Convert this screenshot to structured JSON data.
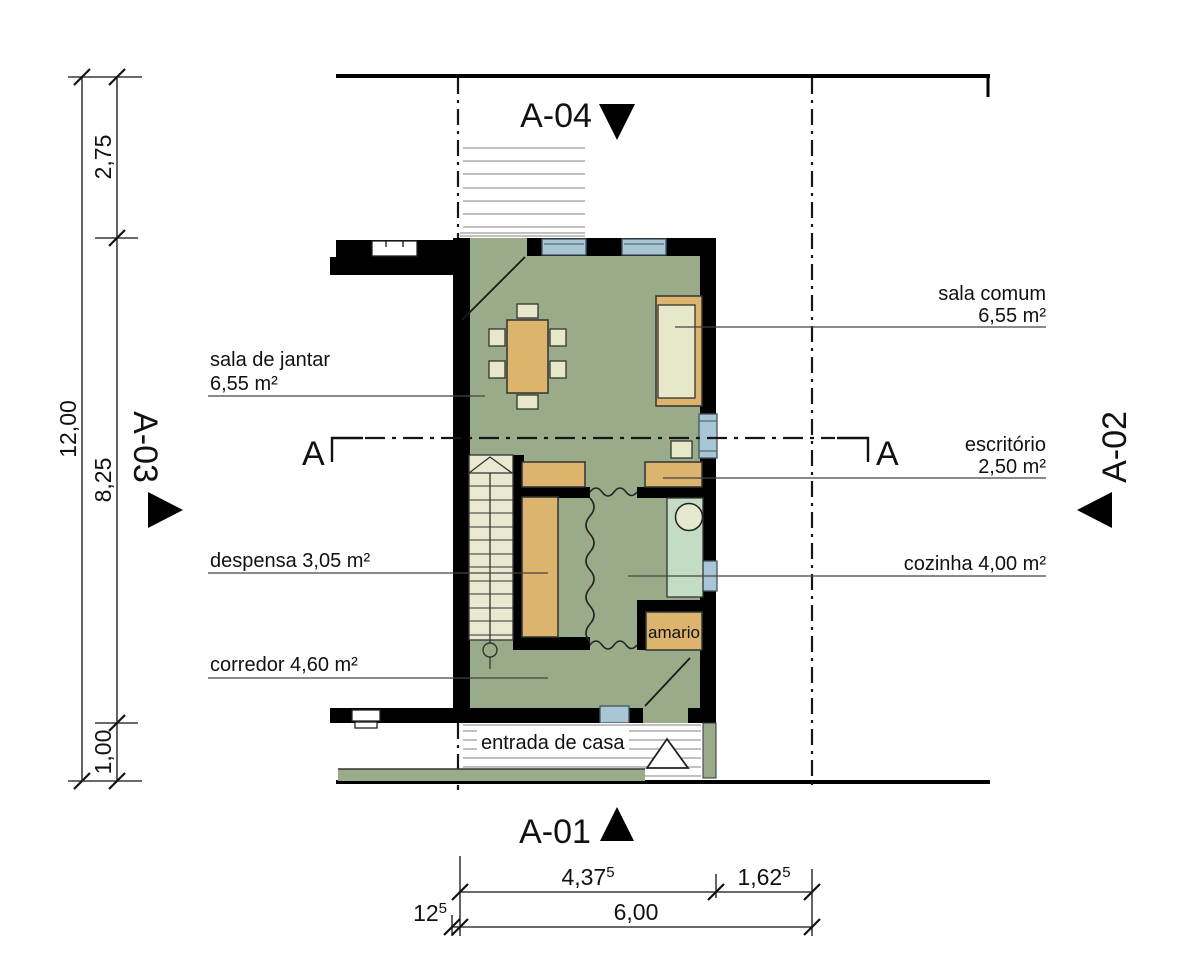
{
  "title": "floor-plan-ground-floor",
  "rooms": {
    "sala_de_jantar": {
      "name": "sala de jantar",
      "area": "6,55 m²"
    },
    "sala_comum": {
      "name": "sala comum",
      "area": "6,55 m²"
    },
    "escritorio": {
      "name": "escritório",
      "area": "2,50 m²"
    },
    "despensa": {
      "label": "despensa 3,05 m²"
    },
    "cozinha": {
      "label": "cozinha 4,00 m²"
    },
    "corredor": {
      "label": "corredor 4,60 m²"
    },
    "amario": {
      "label": "amario"
    },
    "entrada": {
      "label": "entrada de casa"
    }
  },
  "sections": {
    "top": "A-04",
    "bottom": "A-01",
    "left": "A-03",
    "right": "A-02",
    "cut_letter_left": "A",
    "cut_letter_right": "A"
  },
  "dimensions": {
    "left_total": "12,00",
    "left_seg_top": "2,75",
    "left_seg_mid": "8,25",
    "left_seg_bottom": "1,00",
    "bottom_seg1": {
      "v": "4,37",
      "sup": "5"
    },
    "bottom_seg2": {
      "v": "1,62",
      "sup": "5"
    },
    "bottom_offset": {
      "v": "12",
      "sup": "5"
    },
    "bottom_total": "6,00"
  },
  "colors": {
    "floor_green": "#9aab89",
    "furniture_wood": "#dcb46d",
    "furniture_cream": "#e7e8c9",
    "kitchen_counter": "#c3dcc3",
    "window_blue": "#a9c6d7",
    "wall_black": "#000000",
    "deck_stripe": "#9a9a9a"
  }
}
